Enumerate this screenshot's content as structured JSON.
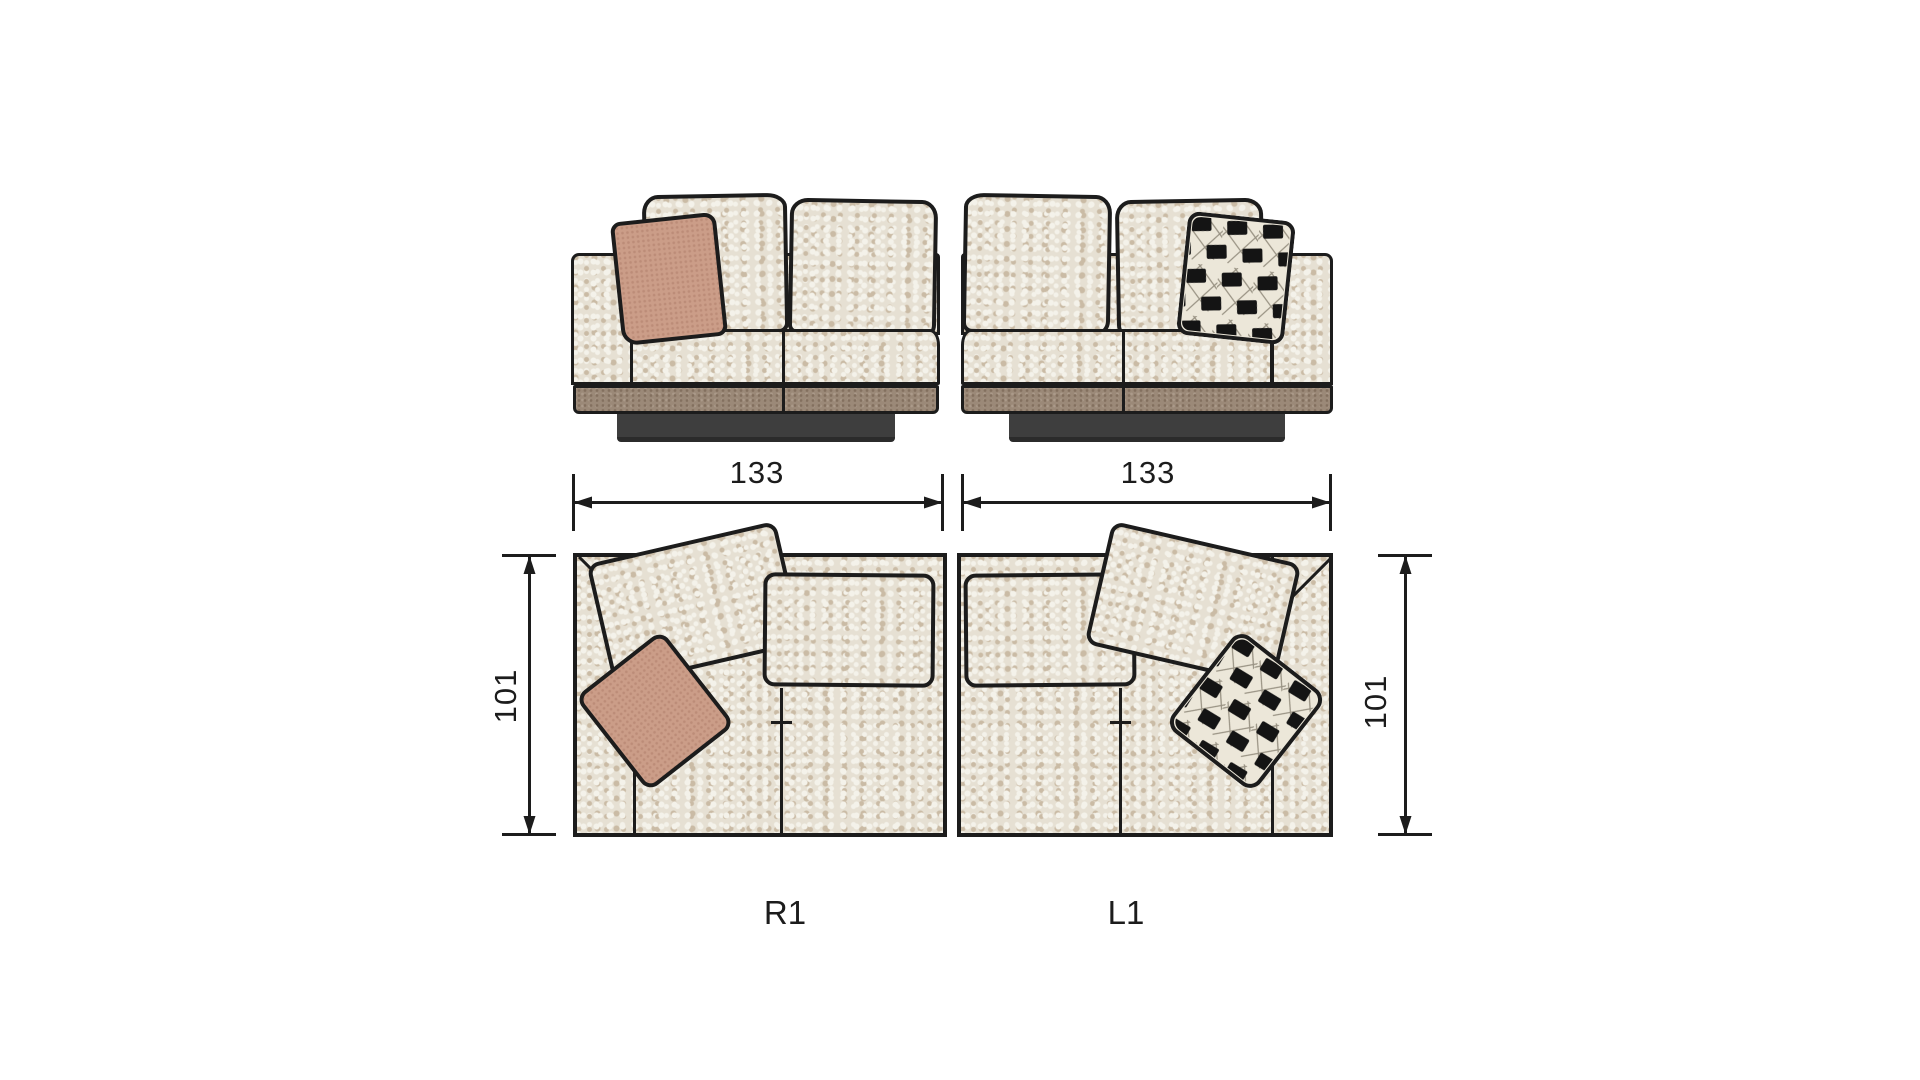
{
  "sheet": {
    "background": "#ffffff",
    "drawing_type": "sofa-module-dimension-diagram"
  },
  "colors": {
    "line": "#1c1c1c",
    "fabric_base": "#e6e0d3",
    "fabric_light": "#f4f2ea",
    "fabric_dark": "#cabba5",
    "leather_base": "#9b8978",
    "leather_light": "#ab9a8a",
    "leather_dark": "#83705f",
    "plinth": "#3e3e3e",
    "plinth_dark": "#2b2b2b",
    "pink": "#cb9d88",
    "pink_dark": "#bc8c78",
    "check_cream": "#ece7d9",
    "check_black": "#141414"
  },
  "modules": [
    {
      "code": "R1",
      "width": "133",
      "depth": "101",
      "arm_side": "left",
      "accent_pillow": "terracotta"
    },
    {
      "code": "L1",
      "width": "133",
      "depth": "101",
      "arm_side": "right",
      "accent_pillow": "black-white-check"
    }
  ]
}
